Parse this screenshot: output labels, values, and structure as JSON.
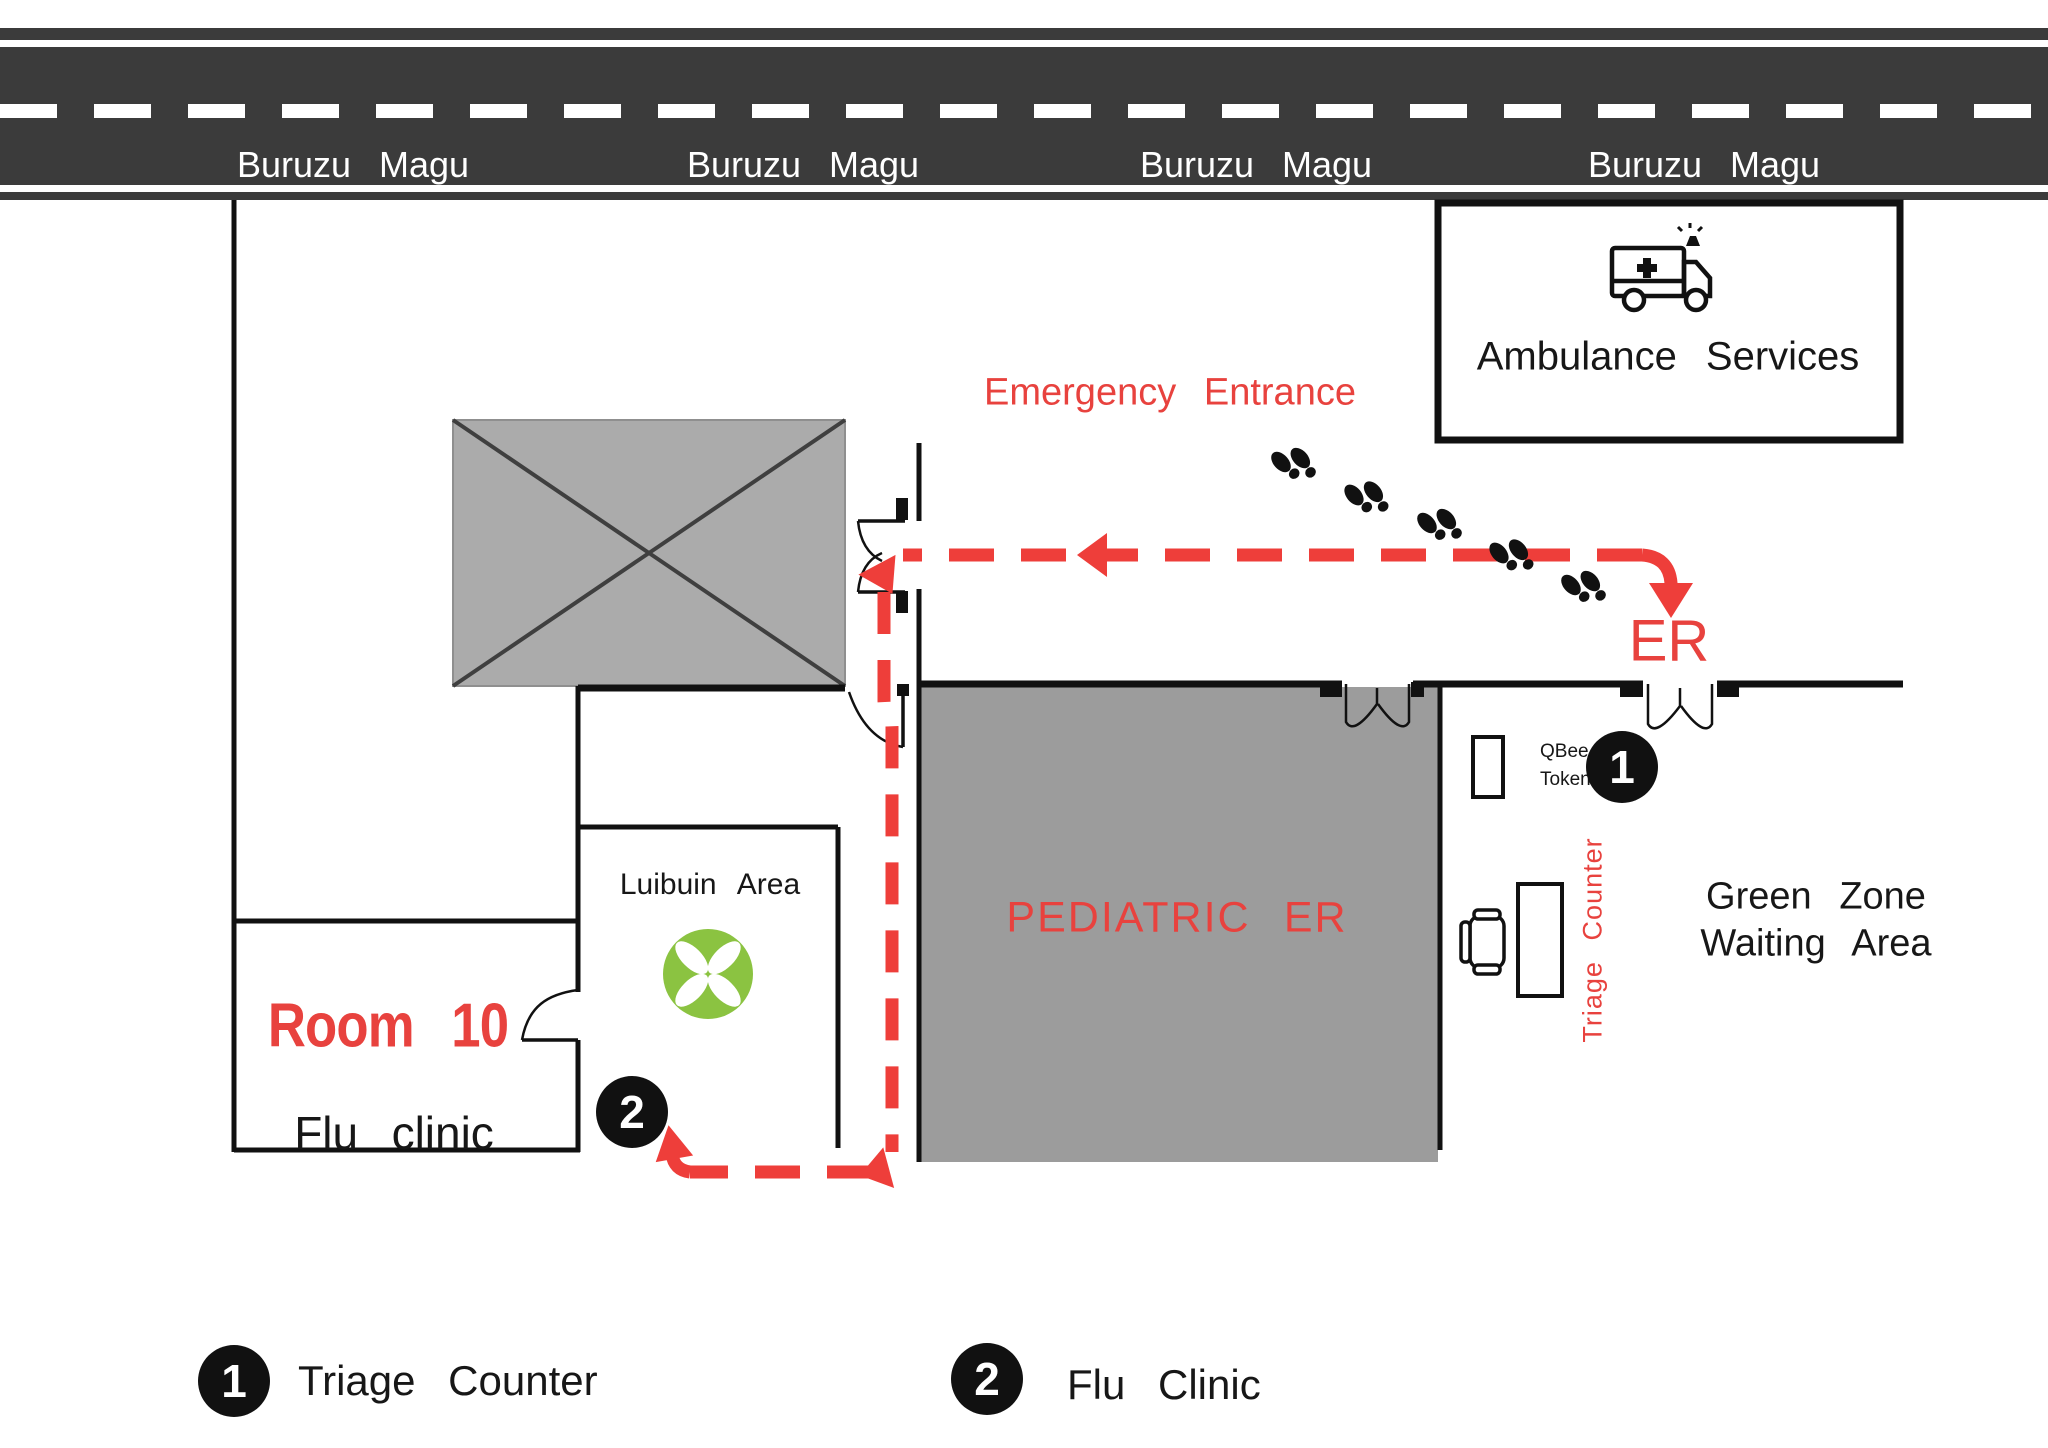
{
  "road": {
    "labels": [
      "Buruzu Magu",
      "Buruzu Magu",
      "Buruzu Magu",
      "Buruzu Magu"
    ]
  },
  "areas": {
    "ambulance_services": "Ambulance Services",
    "emergency_entrance": "Emergency Entrance",
    "er": "ER",
    "pediatric_er": "PEDIATRIC ER",
    "green_zone_line1": "Green Zone",
    "green_zone_line2": "Waiting Area",
    "luibuin_area": "Luibuin Area",
    "room10_title": "Room 10",
    "room10_subtitle": "Flu clinic",
    "triage_counter": "Triage Counter",
    "qbee_line1": "QBee",
    "qbee_line2": "Token"
  },
  "markers": {
    "triage": "1",
    "flu": "2"
  },
  "legend": {
    "items": [
      {
        "num": "1",
        "label": "Triage Counter"
      },
      {
        "num": "2",
        "label": "Flu Clinic"
      }
    ]
  },
  "icons": {
    "ambulance": "ambulance-icon",
    "plant": "plant-icon",
    "desk": "triage-desk-icon",
    "chair": "chair-icon",
    "footprints": "footprints-icon",
    "token_stand": "qbee-token-stand"
  },
  "colors": {
    "road": "#3b3b3b",
    "accent_red": "#e8423e",
    "path_red": "#ee3e3a",
    "blocked_area_gray": "#ababab",
    "pediatric_gray": "#9c9c9c",
    "plant_green": "#8bc341",
    "wall_black": "#111111"
  }
}
